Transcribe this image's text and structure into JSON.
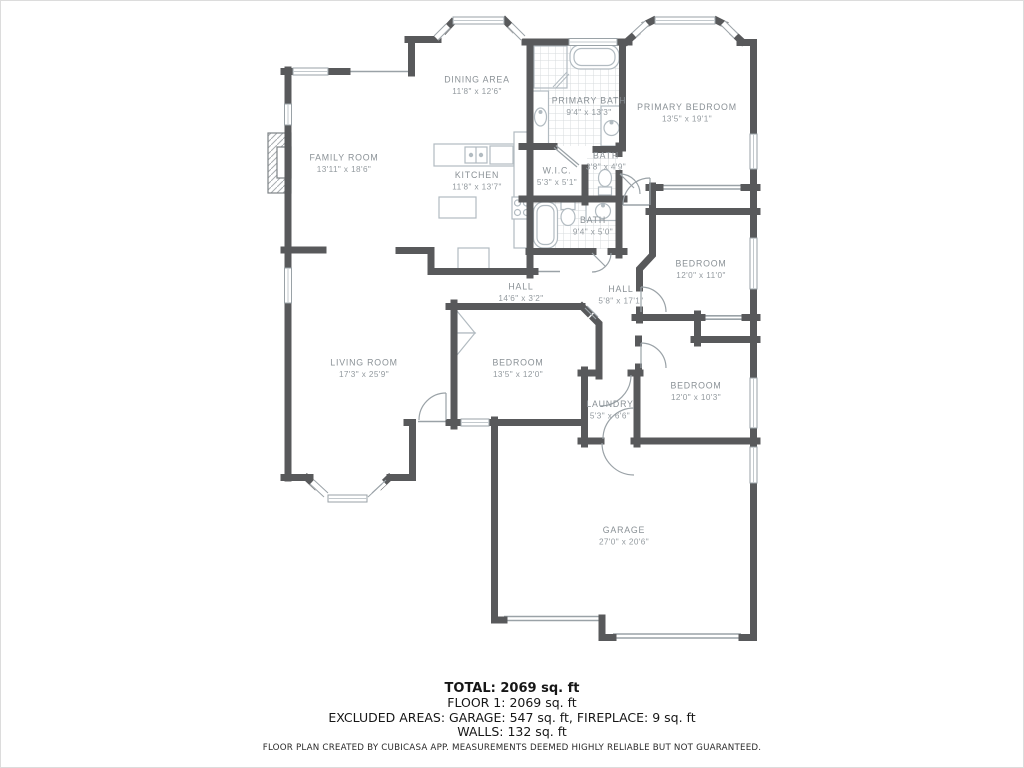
{
  "plan": {
    "colors": {
      "wall": "#58595b",
      "fixture": "#b2bbc1",
      "label": "#8a9196",
      "tile": "#d7dbdd",
      "thin": "#9aa2a7"
    },
    "rooms": [
      {
        "id": "dining-area",
        "name": "DINING AREA",
        "dims": "11'8\" x 12'6\""
      },
      {
        "id": "family-room",
        "name": "FAMILY ROOM",
        "dims": "13'11\" x 18'6\""
      },
      {
        "id": "kitchen",
        "name": "KITCHEN",
        "dims": "11'8\" x 13'7\""
      },
      {
        "id": "primary-bath",
        "name": "PRIMARY BATH",
        "dims": "9'4\" x 13'3\""
      },
      {
        "id": "primary-bedroom",
        "name": "PRIMARY BEDROOM",
        "dims": "13'5\" x 19'1\""
      },
      {
        "id": "wic",
        "name": "W.I.C.",
        "dims": "5'3\" x 5'1\""
      },
      {
        "id": "bath-small",
        "name": "BATH",
        "dims": "3'8\" x 4'9\""
      },
      {
        "id": "bath-main",
        "name": "BATH",
        "dims": "9'4\" x 5'0\""
      },
      {
        "id": "bedroom-ne",
        "name": "BEDROOM",
        "dims": "12'0\" x 11'0\""
      },
      {
        "id": "hall-vertical",
        "name": "HALL",
        "dims": "5'8\" x 17'1\""
      },
      {
        "id": "hall-horizontal",
        "name": "HALL",
        "dims": "14'6\" x 3'2\""
      },
      {
        "id": "living-room",
        "name": "LIVING ROOM",
        "dims": "17'3\" x 25'9\""
      },
      {
        "id": "bedroom-center",
        "name": "BEDROOM",
        "dims": "13'5\" x 12'0\""
      },
      {
        "id": "laundry",
        "name": "LAUNDRY",
        "dims": "5'3\" x 6'6\""
      },
      {
        "id": "bedroom-se",
        "name": "BEDROOM",
        "dims": "12'0\" x 10'3\""
      },
      {
        "id": "garage",
        "name": "GARAGE",
        "dims": "27'0\" x 20'6\""
      }
    ]
  },
  "summary": {
    "total": "TOTAL: 2069 sq. ft",
    "floor1": "FLOOR 1: 2069 sq. ft",
    "excluded": "EXCLUDED AREAS: GARAGE: 547 sq. ft, FIREPLACE: 9 sq. ft",
    "walls": "WALLS: 132 sq. ft"
  },
  "footer": {
    "disclaimer": "FLOOR PLAN CREATED BY CUBICASA APP. MEASUREMENTS DEEMED HIGHLY RELIABLE BUT NOT GUARANTEED."
  }
}
